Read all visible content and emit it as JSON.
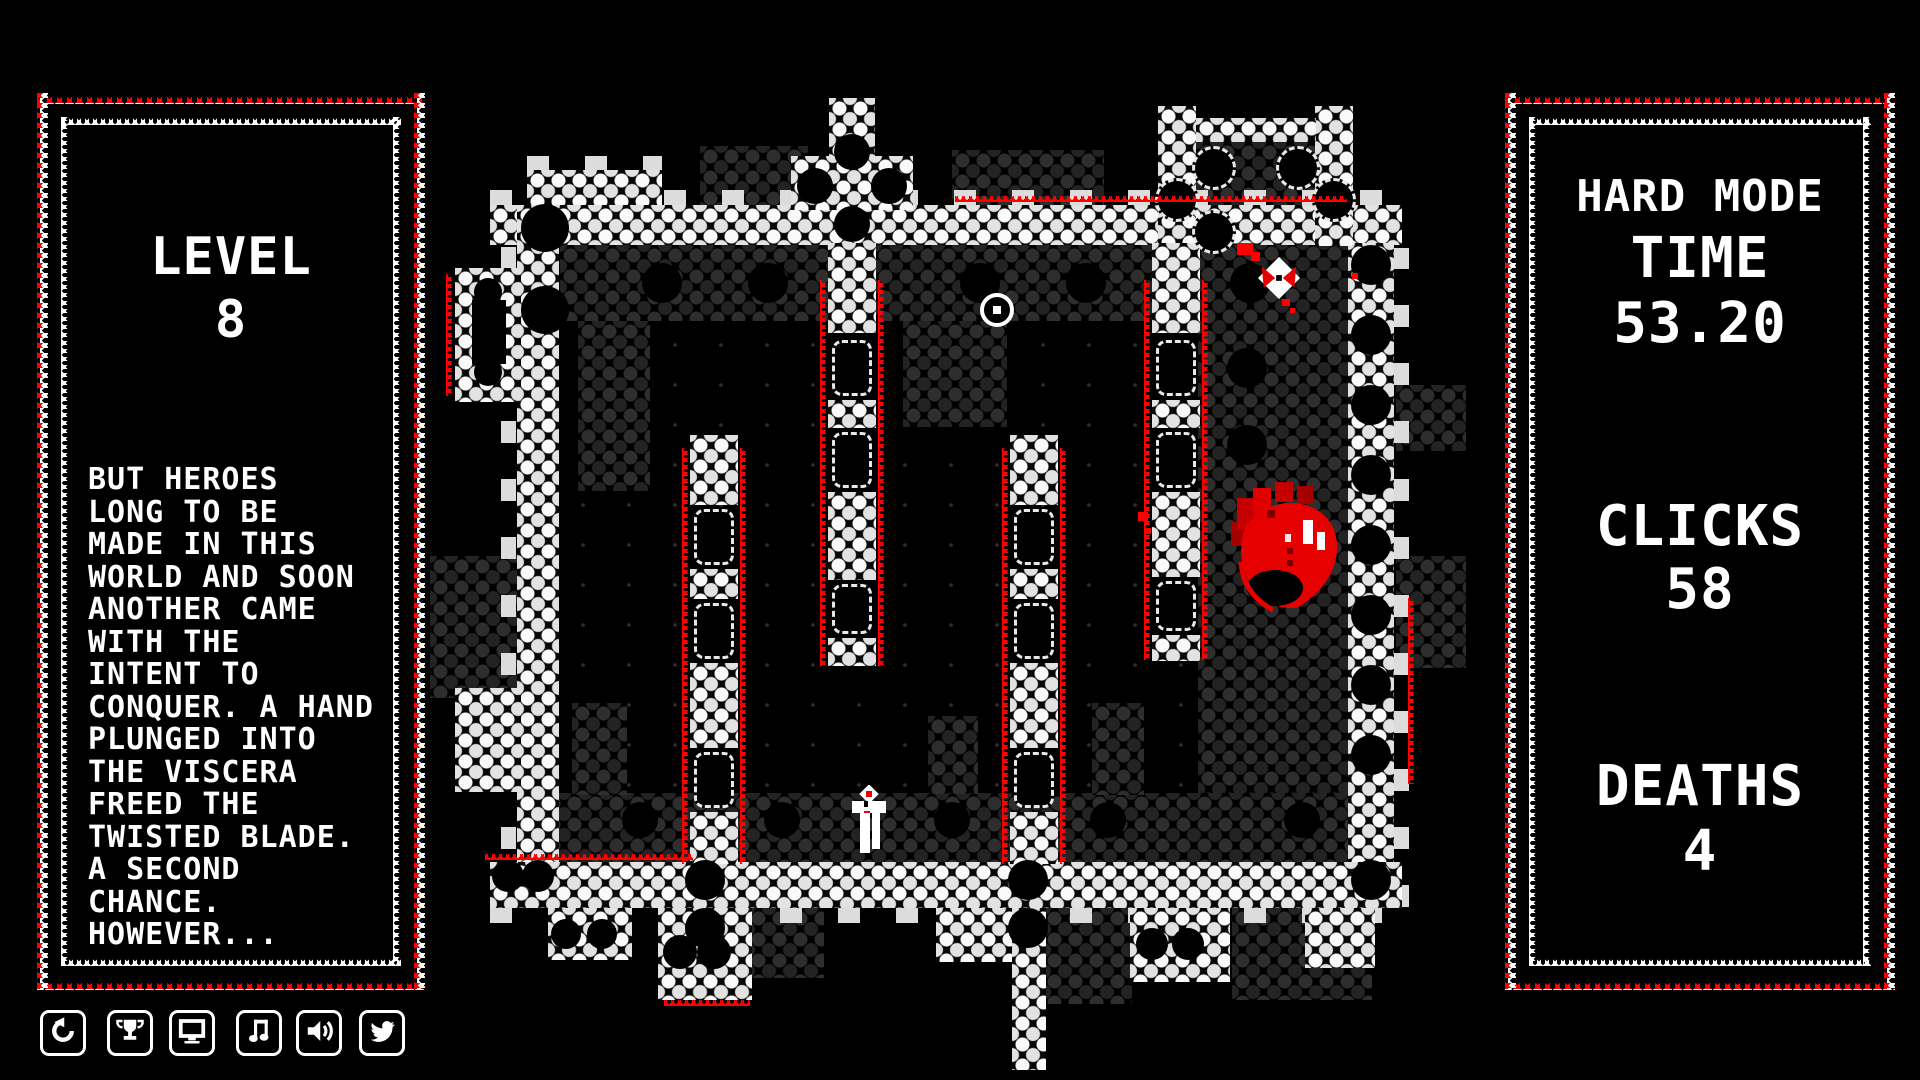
{
  "left_panel": {
    "level_label": "LEVEL",
    "level_value": "8",
    "story": [
      "BUT HEROES",
      "LONG TO BE",
      "MADE IN THIS",
      "WORLD AND SOON",
      "ANOTHER CAME",
      "WITH THE",
      "INTENT TO",
      "CONQUER. A HAND",
      "PLUNGED INTO",
      "THE VISCERA",
      "FREED THE",
      "TWISTED BLADE.",
      "A SECOND",
      "CHANCE.",
      "HOWEVER..."
    ]
  },
  "right_panel": {
    "mode": "HARD MODE",
    "time_label": "TIME",
    "time_value": "53.20",
    "clicks_label": "CLICKS",
    "clicks_value": "58",
    "deaths_label": "DEATHS",
    "deaths_value": "4"
  },
  "toolbar": {
    "icons": [
      "restart-icon",
      "trophy-icon",
      "display-icon",
      "music-icon",
      "sound-icon",
      "twitter-icon"
    ]
  },
  "game": {
    "entities": [
      "target-reticle",
      "blade-pickup",
      "anatomical-heart",
      "player-character"
    ]
  },
  "colors": {
    "background": "#000000",
    "text": "#ffffff",
    "accent_red": "#ff0000",
    "wall_light": "#f5f5f5",
    "wall_dark": "#2b2b2b"
  }
}
